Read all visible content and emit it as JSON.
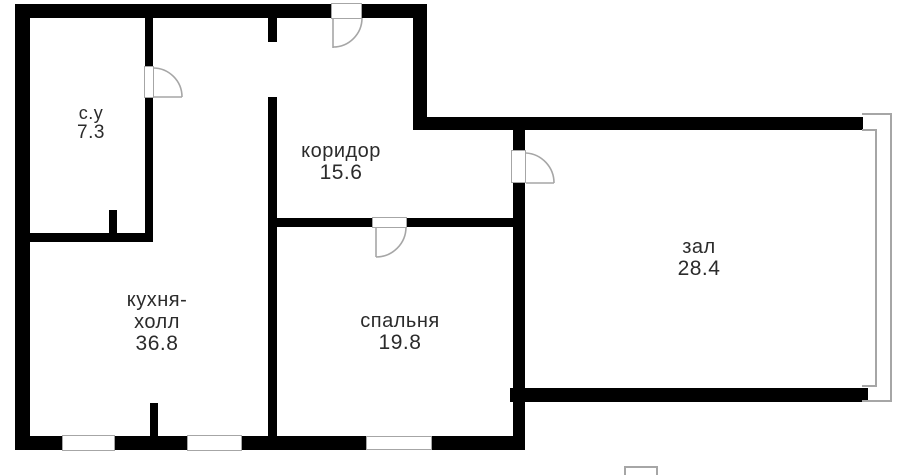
{
  "plan": {
    "rooms": [
      {
        "id": "bathroom",
        "lines": [
          "с.у"
        ],
        "area": "7.3"
      },
      {
        "id": "corridor",
        "lines": [
          "коридор"
        ],
        "area": "15.6"
      },
      {
        "id": "kitchen-hall",
        "lines": [
          "кухня-",
          "холл"
        ],
        "area": "36.8"
      },
      {
        "id": "bedroom",
        "lines": [
          "спальня"
        ],
        "area": "19.8"
      },
      {
        "id": "hall",
        "lines": [
          "зал"
        ],
        "area": "28.4"
      }
    ]
  },
  "colors": {
    "wall": "#000000",
    "frame": "#a6a6a6",
    "text": "#2b2b2b",
    "background": "#ffffff"
  }
}
